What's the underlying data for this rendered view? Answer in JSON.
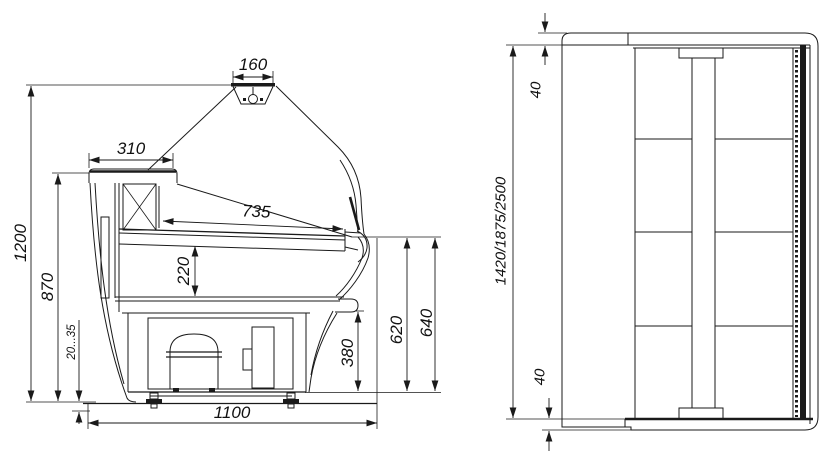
{
  "side_view": {
    "lamp_width": "160",
    "canopy_depth": "310",
    "deck_depth": "735",
    "well_depth": "220",
    "overall_height": "1200",
    "counter_height": "870",
    "leg_adjustment": "20...35",
    "bumper_height": "380",
    "front_panel_height": "620",
    "nose_height": "640",
    "overall_depth": "1100"
  },
  "plan_view": {
    "top_end_thickness": "40",
    "length_variants": "1420/1875/2500",
    "bottom_end_thickness": "40"
  }
}
